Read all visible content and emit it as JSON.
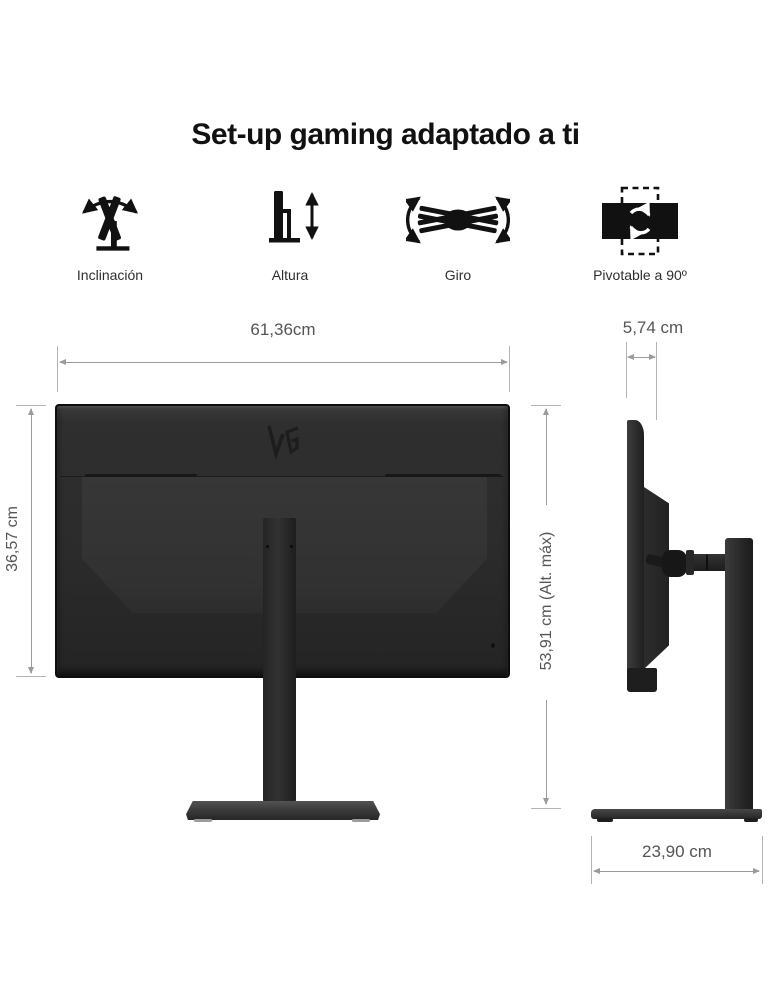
{
  "title": "Set-up gaming adaptado a ti",
  "features": [
    {
      "label": "Inclinación",
      "icon": "tilt-icon"
    },
    {
      "label": "Altura",
      "icon": "height-icon"
    },
    {
      "label": "Giro",
      "icon": "swivel-icon"
    },
    {
      "label": "Pivotable a 90º",
      "icon": "pivot-icon"
    }
  ],
  "rear_view": {
    "logo": "ultragear-logo"
  },
  "dimensions": {
    "width": "61,36cm",
    "panel_height": "36,57 cm",
    "max_height": "53,91 cm (Alt. máx)",
    "depth": "5,74 cm",
    "base_depth": "23,90 cm"
  },
  "colors": {
    "background": "#ffffff",
    "title_text": "#111111",
    "feature_label_text": "#2e2e2e",
    "dimension_text": "#555555",
    "dimension_line": "#9b9b9b",
    "monitor_body": "#2d2d2d",
    "icon": "#111111"
  }
}
